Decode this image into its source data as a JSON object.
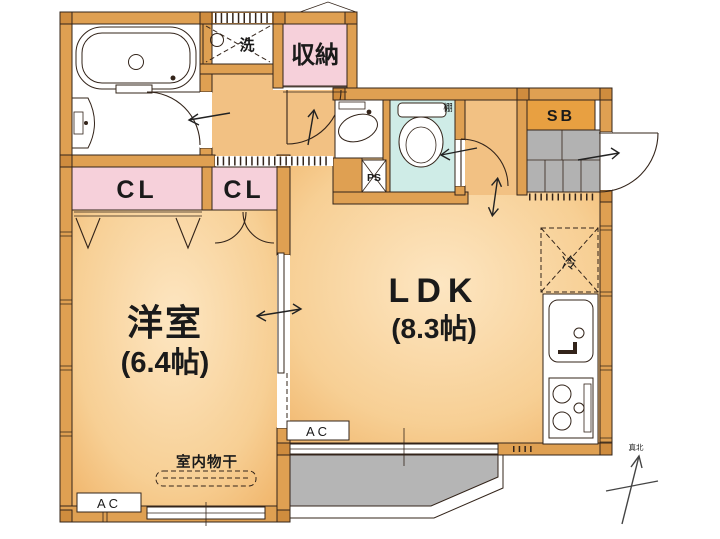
{
  "plan": {
    "labels": {
      "western_room_name": "洋室",
      "western_room_size": "(6.4帖)",
      "ldk_name": "LDK",
      "ldk_size": "(8.3帖)",
      "storage": "収納",
      "closet_large": "CL",
      "closet_small": "CL",
      "shoe_box": "SB",
      "pipe_space": "PS",
      "laundry": "洗",
      "shelf": "棚",
      "refrigerator": "冷",
      "ac_west": "AC",
      "ac_ldk": "AC",
      "indoor_drying": "室内物干",
      "true_north": "真北"
    },
    "colors": {
      "wall": "#dfa052",
      "room_center": "#fde6c2",
      "room_edge": "#f0b469",
      "corridor": "#f2c183",
      "closet_pink": "#f6d0da",
      "toilet_cyan": "#cfece7",
      "entry_gray": "#b2b2b2",
      "balcony_gray": "#b5b5b5",
      "shoe_box_fill": "#e8a041",
      "outline": "#33241a"
    }
  }
}
